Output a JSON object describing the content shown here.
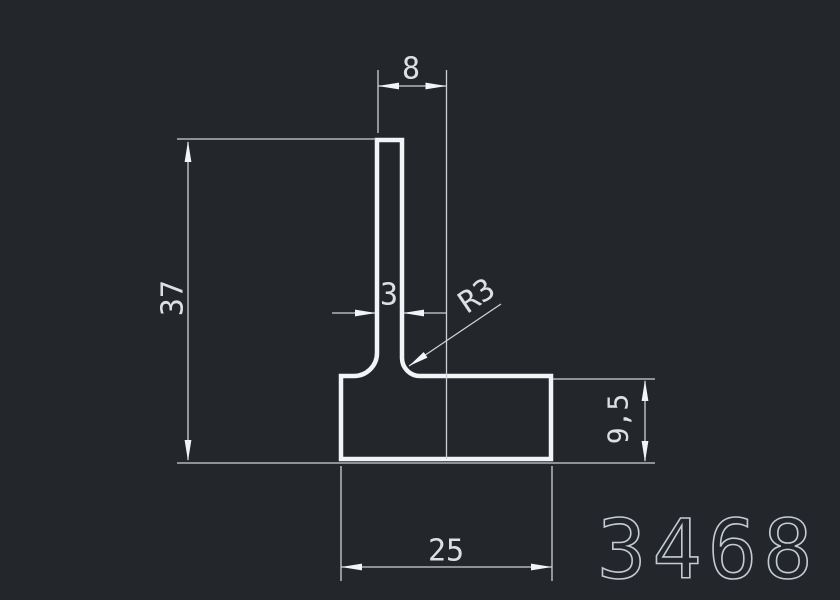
{
  "drawing": {
    "part_number": "3468",
    "dimensions": {
      "top_width": "8",
      "overall_height": "37",
      "stem_thickness": "3",
      "fillet_radius": "R3",
      "base_height": "9,5",
      "base_width": "25"
    },
    "colors": {
      "background": "#23272c",
      "profile_line": "#f2f4f6",
      "dimension_line": "#cdd2d7",
      "text": "#dde0e3",
      "part_number": "#c6cbd1"
    }
  }
}
